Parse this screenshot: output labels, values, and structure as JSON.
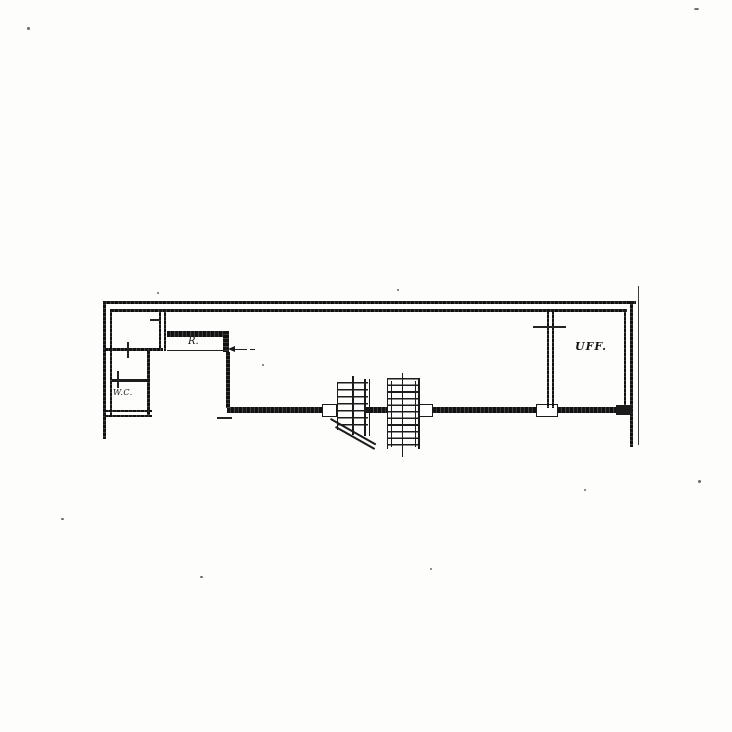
{
  "page": {
    "paper_color": "#fdfdfc",
    "ink_color": "#1c1c1c"
  },
  "plan": {
    "rooms": [
      {
        "id": "wc",
        "label": "W.C."
      },
      {
        "id": "storage",
        "label": "R."
      },
      {
        "id": "office",
        "label": "UFF."
      }
    ],
    "symbols": [
      "stair-run-small",
      "stair-run-large",
      "stair-cut-line",
      "entrance-arrow",
      "door-marks",
      "boundary-line"
    ]
  }
}
